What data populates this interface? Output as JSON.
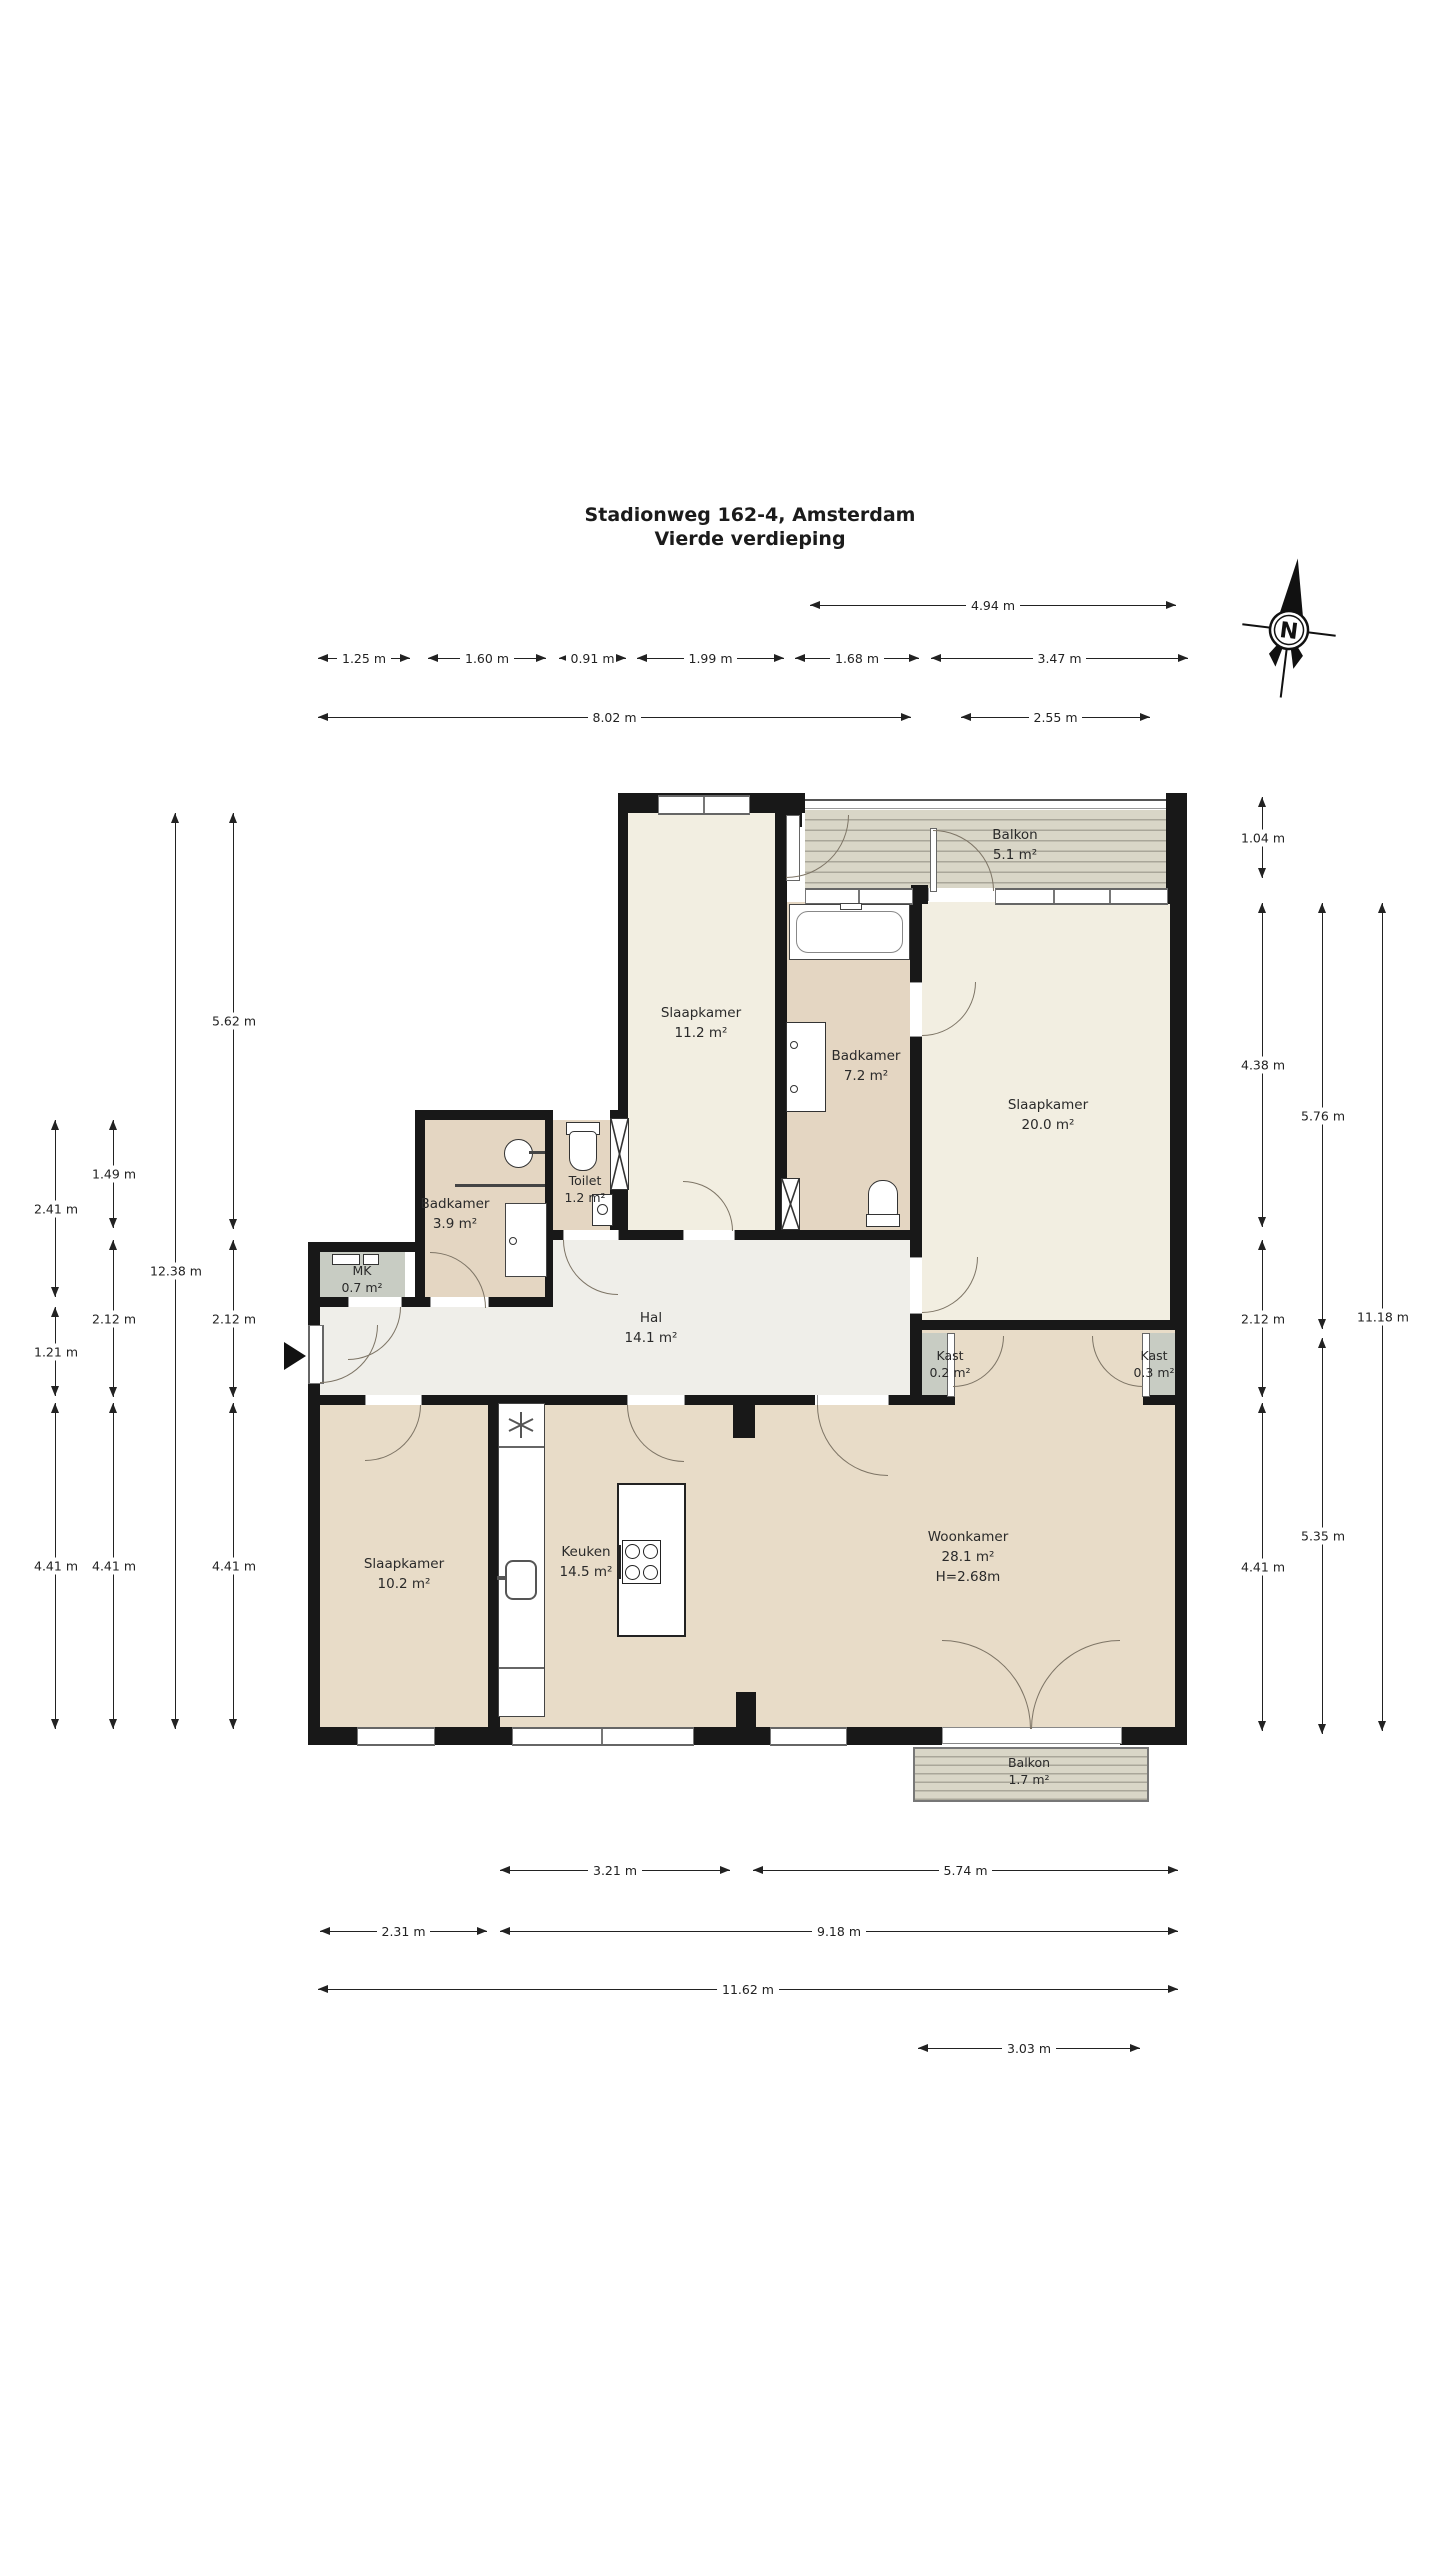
{
  "title": {
    "line1": "Stadionweg 162-4, Amsterdam",
    "line2": "Vierde verdieping"
  },
  "compass": {
    "label": "N"
  },
  "rooms": {
    "balkon_top": {
      "name": "Balkon",
      "area": "5.1 m²"
    },
    "slaapkamer_11": {
      "name": "Slaapkamer",
      "area": "11.2 m²"
    },
    "badkamer_7": {
      "name": "Badkamer",
      "area": "7.2 m²"
    },
    "slaapkamer_20": {
      "name": "Slaapkamer",
      "area": "20.0 m²"
    },
    "toilet": {
      "name": "Toilet",
      "area": "1.2 m²"
    },
    "badkamer_3": {
      "name": "Badkamer",
      "area": "3.9 m²"
    },
    "mk": {
      "name": "MK",
      "area": "0.7 m²"
    },
    "hal": {
      "name": "Hal",
      "area": "14.1 m²"
    },
    "kast_02": {
      "name": "Kast",
      "area": "0.2 m²"
    },
    "kast_03": {
      "name": "Kast",
      "area": "0.3 m²"
    },
    "slaapkamer_10": {
      "name": "Slaapkamer",
      "area": "10.2 m²"
    },
    "keuken": {
      "name": "Keuken",
      "area": "14.5 m²"
    },
    "woonkamer": {
      "name": "Woonkamer",
      "area": "28.1 m²",
      "ceiling": "H=2.68m"
    },
    "balkon_bottom": {
      "name": "Balkon",
      "area": "1.7 m²"
    }
  },
  "dims": {
    "d091": "0.91 m",
    "d104": "1.04 m",
    "d121": "1.21 m",
    "d125": "1.25 m",
    "d149": "1.49 m",
    "d160": "1.60 m",
    "d168": "1.68 m",
    "d199": "1.99 m",
    "d212": "2.12 m",
    "d231": "2.31 m",
    "d241": "2.41 m",
    "d255": "2.55 m",
    "d303": "3.03 m",
    "d321": "3.21 m",
    "d347": "3.47 m",
    "d438": "4.38 m",
    "d441": "4.41 m",
    "d494": "4.94 m",
    "d535": "5.35 m",
    "d562": "5.62 m",
    "d574": "5.74 m",
    "d576": "5.76 m",
    "d802": "8.02 m",
    "d918": "9.18 m",
    "d1118": "11.18 m",
    "d1162": "11.62 m",
    "d1238": "12.38 m"
  },
  "colors": {
    "wall": "#181818",
    "room_cream": "#f2eee1",
    "room_tan": "#e8dcc8",
    "room_tan_dark": "#e4d6c2",
    "hall": "#efeee9",
    "closet": "#c8ccc3",
    "balcony": "#d9d6c7",
    "balcony_line": "#a9a699",
    "dimension": "#222222"
  }
}
